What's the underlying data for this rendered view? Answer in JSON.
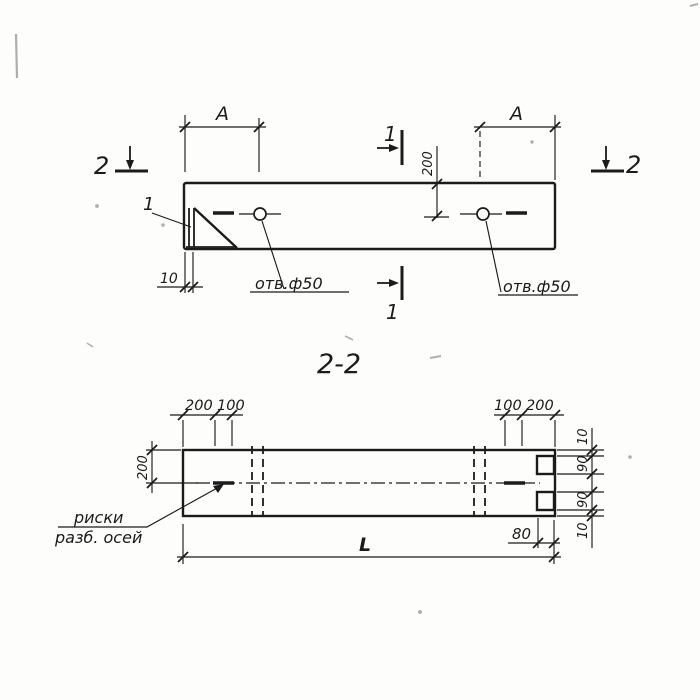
{
  "document": {
    "kind": "scanned structural drawing",
    "section_title": "2-2"
  },
  "colors": {
    "ink": "#1b1b1b",
    "paper": "#fdfdfc"
  },
  "plan_view": {
    "dim_a_left": "A",
    "dim_a_right": "A",
    "dim_200": "200",
    "dim_10": "10",
    "hole_label_left": "отв.ф50",
    "hole_label_right": "отв.ф50",
    "callout_1": "1",
    "section_mark_2_left": "2",
    "section_mark_2_right": "2",
    "section_mark_1_top": "1",
    "section_mark_1_bottom": "1"
  },
  "section_view": {
    "title": "2-2",
    "dims_top_left": [
      "200",
      "100"
    ],
    "dims_top_right": [
      "100",
      "200"
    ],
    "dim_width_200": "200",
    "dims_right": [
      "10",
      "90",
      "90",
      "10"
    ],
    "dim_80": "80",
    "dim_length": "L",
    "axes_note_line1": "риски",
    "axes_note_line2": "разб. осей"
  }
}
